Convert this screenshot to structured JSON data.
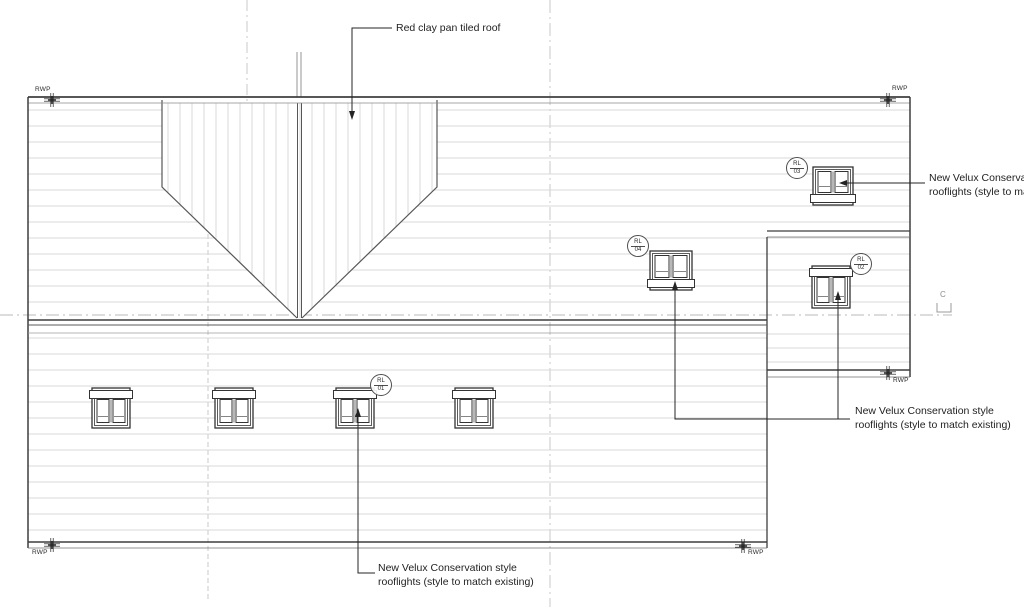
{
  "annotations": {
    "roof_material": "Red clay pan tiled roof",
    "rooflight_top_right": {
      "line1": "New Velux Conservatio",
      "line2": "rooflights (style to matc"
    },
    "rooflight_mid_right": {
      "line1": "New Velux Conservation style",
      "line2": "rooflights (style to match existing)"
    },
    "rooflight_bottom": {
      "line1": "New Velux Conservation style",
      "line2": "rooflights (style to match existing)"
    }
  },
  "labels": {
    "rwp": "RWP",
    "grid_c": "C"
  },
  "rooflight_tags": {
    "rl01": {
      "code": "RL",
      "num": "01"
    },
    "rl02": {
      "code": "RL",
      "num": "02"
    },
    "rl03": {
      "code": "RL",
      "num": "03"
    },
    "rl04": {
      "code": "RL",
      "num": "04"
    }
  },
  "colors": {
    "outline": "#3f3f3f",
    "course_line": "#d9d9d9",
    "centerline": "#b8b8b8",
    "annotation_text": "#1f1f1f"
  }
}
